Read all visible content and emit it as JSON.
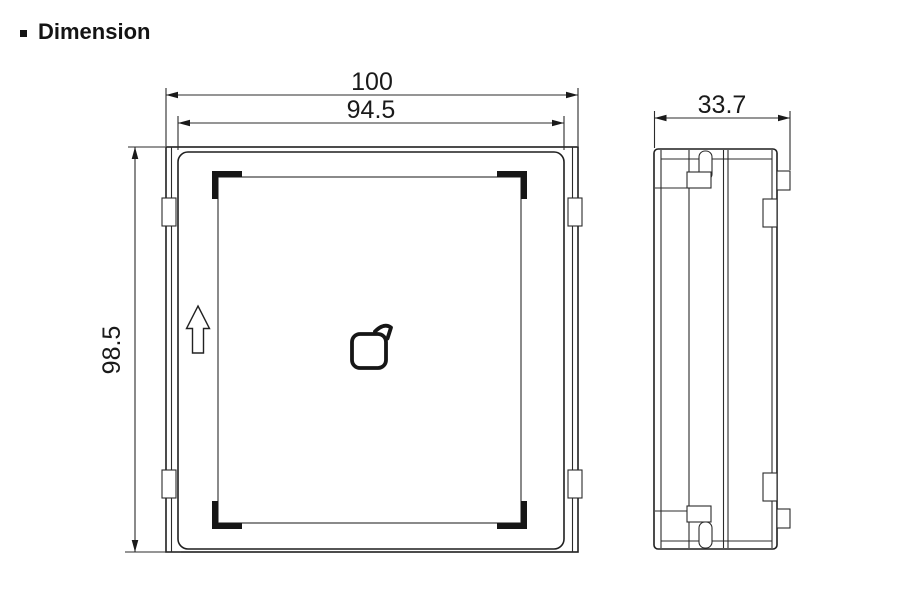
{
  "header": {
    "title": "Dimension"
  },
  "front_view": {
    "outer_width": "100",
    "panel_width": "94.5",
    "height": "98.5"
  },
  "side_view": {
    "depth": "33.7"
  },
  "icons": {
    "bullet": "square-bullet",
    "orientation": "up-arrow",
    "center": "card-tap-logo"
  },
  "colors": {
    "line": "#2b2b2b",
    "outline": "#1f1f1f",
    "text": "#1a1a1a",
    "background": "#ffffff"
  }
}
